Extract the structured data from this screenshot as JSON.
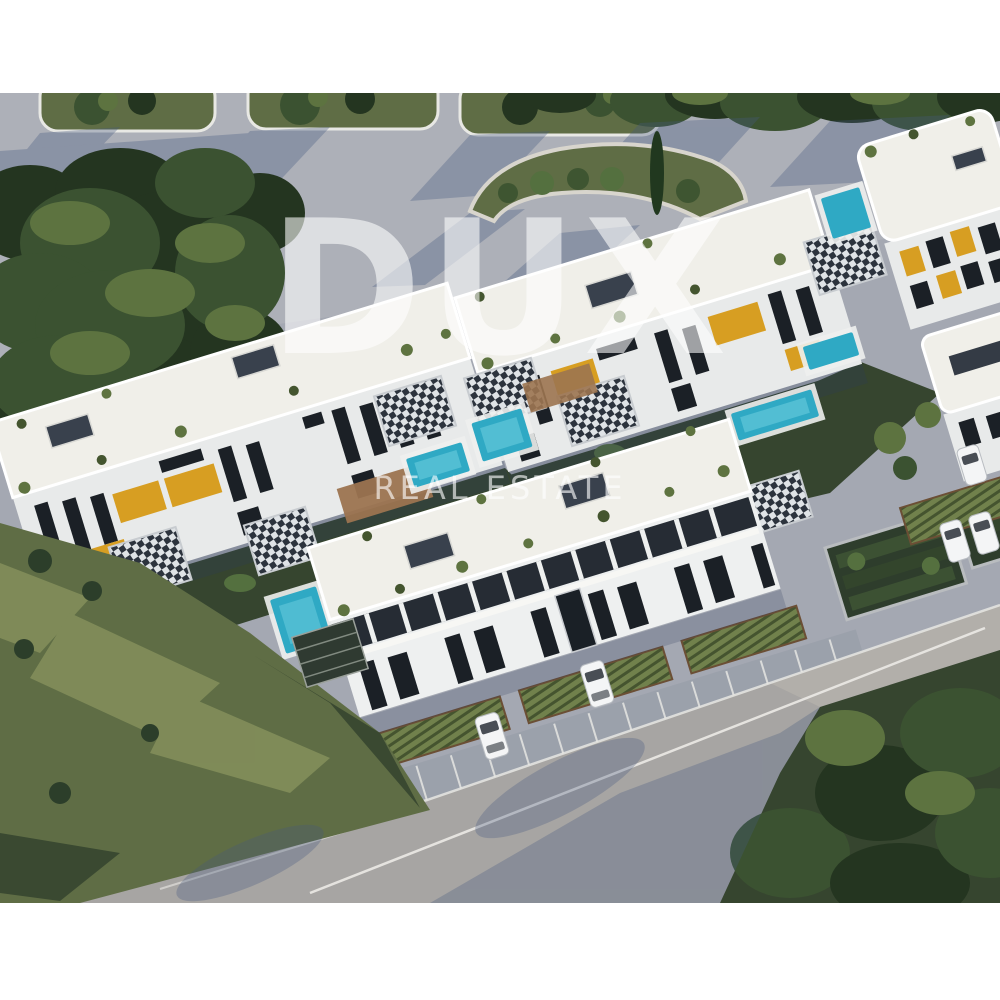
{
  "watermark": {
    "brand": "DUX",
    "tagline": "REAL ESTATE"
  },
  "palette": {
    "margin_white": "#ffffff",
    "road_base": "#a4a8b2",
    "asphalt_warm": "#a7a5a3",
    "asphalt_sunlit": "#b5b1ab",
    "road_shadow": "#46597f",
    "curb_white": "#e8e8e4",
    "grass_sun": "#87925d",
    "grass_mid": "#5f6d45",
    "grass_dark": "#36452f",
    "tree_dark": "#243520",
    "tree_mid": "#3b5231",
    "tree_light": "#5d7340",
    "wall_white": "#f6f5f1",
    "wall_shade": "#e8eaea",
    "roof_white": "#f0efe9",
    "window_dark": "#1b2026",
    "accent_ochre": "#d79e22",
    "pool_teal": "#2fa9c4",
    "pool_light": "#6fd0e0",
    "deck_wood": "#9c7450",
    "car_white": "#f4f5f6",
    "watermark_white": "#ffffff"
  }
}
